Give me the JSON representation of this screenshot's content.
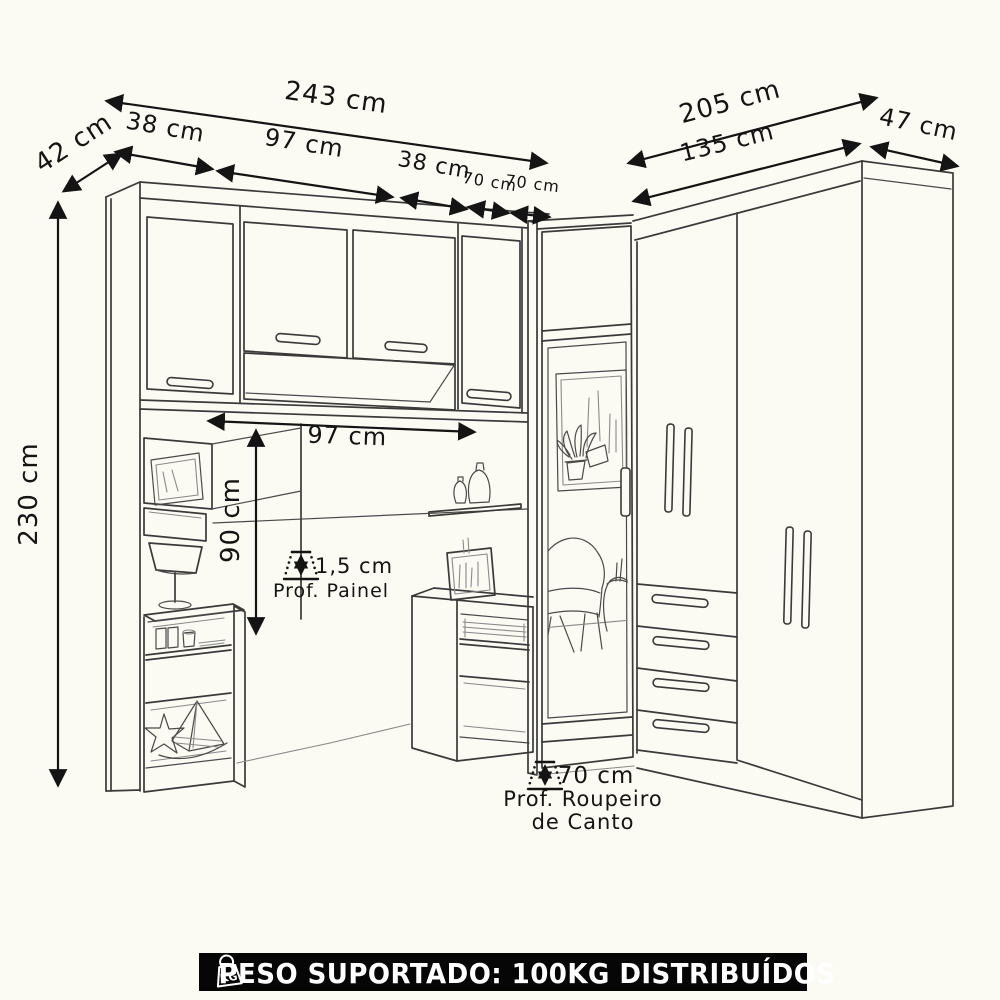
{
  "colors": {
    "background": "#fbfaf3",
    "line": "#3a3a3a",
    "dimension": "#141414",
    "banner_bg": "#060606",
    "banner_fg": "#ffffff"
  },
  "dims": {
    "total_width": "243 cm",
    "side_depth": "42 cm",
    "left_door_width": "38 cm",
    "center_width": "97 cm",
    "right_door_width": "38 cm",
    "corner_left_width": "70 cm",
    "corner_right_width": "70 cm",
    "right_total_width": "205 cm",
    "right_front_width": "135 cm",
    "right_side_depth": "47 cm",
    "height": "230 cm",
    "niche_width": "97 cm",
    "niche_height": "90 cm",
    "panel_depth": "1,5 cm",
    "panel_depth_caption": "Prof. Painel",
    "corner_depth": "70 cm",
    "corner_depth_caption_line1": "Prof. Roupeiro",
    "corner_depth_caption_line2": "de Canto"
  },
  "banner": {
    "weight_icon_text": "KG",
    "text": "PESO SUPORTADO: 100KG DISTRIBUÍDOS"
  }
}
